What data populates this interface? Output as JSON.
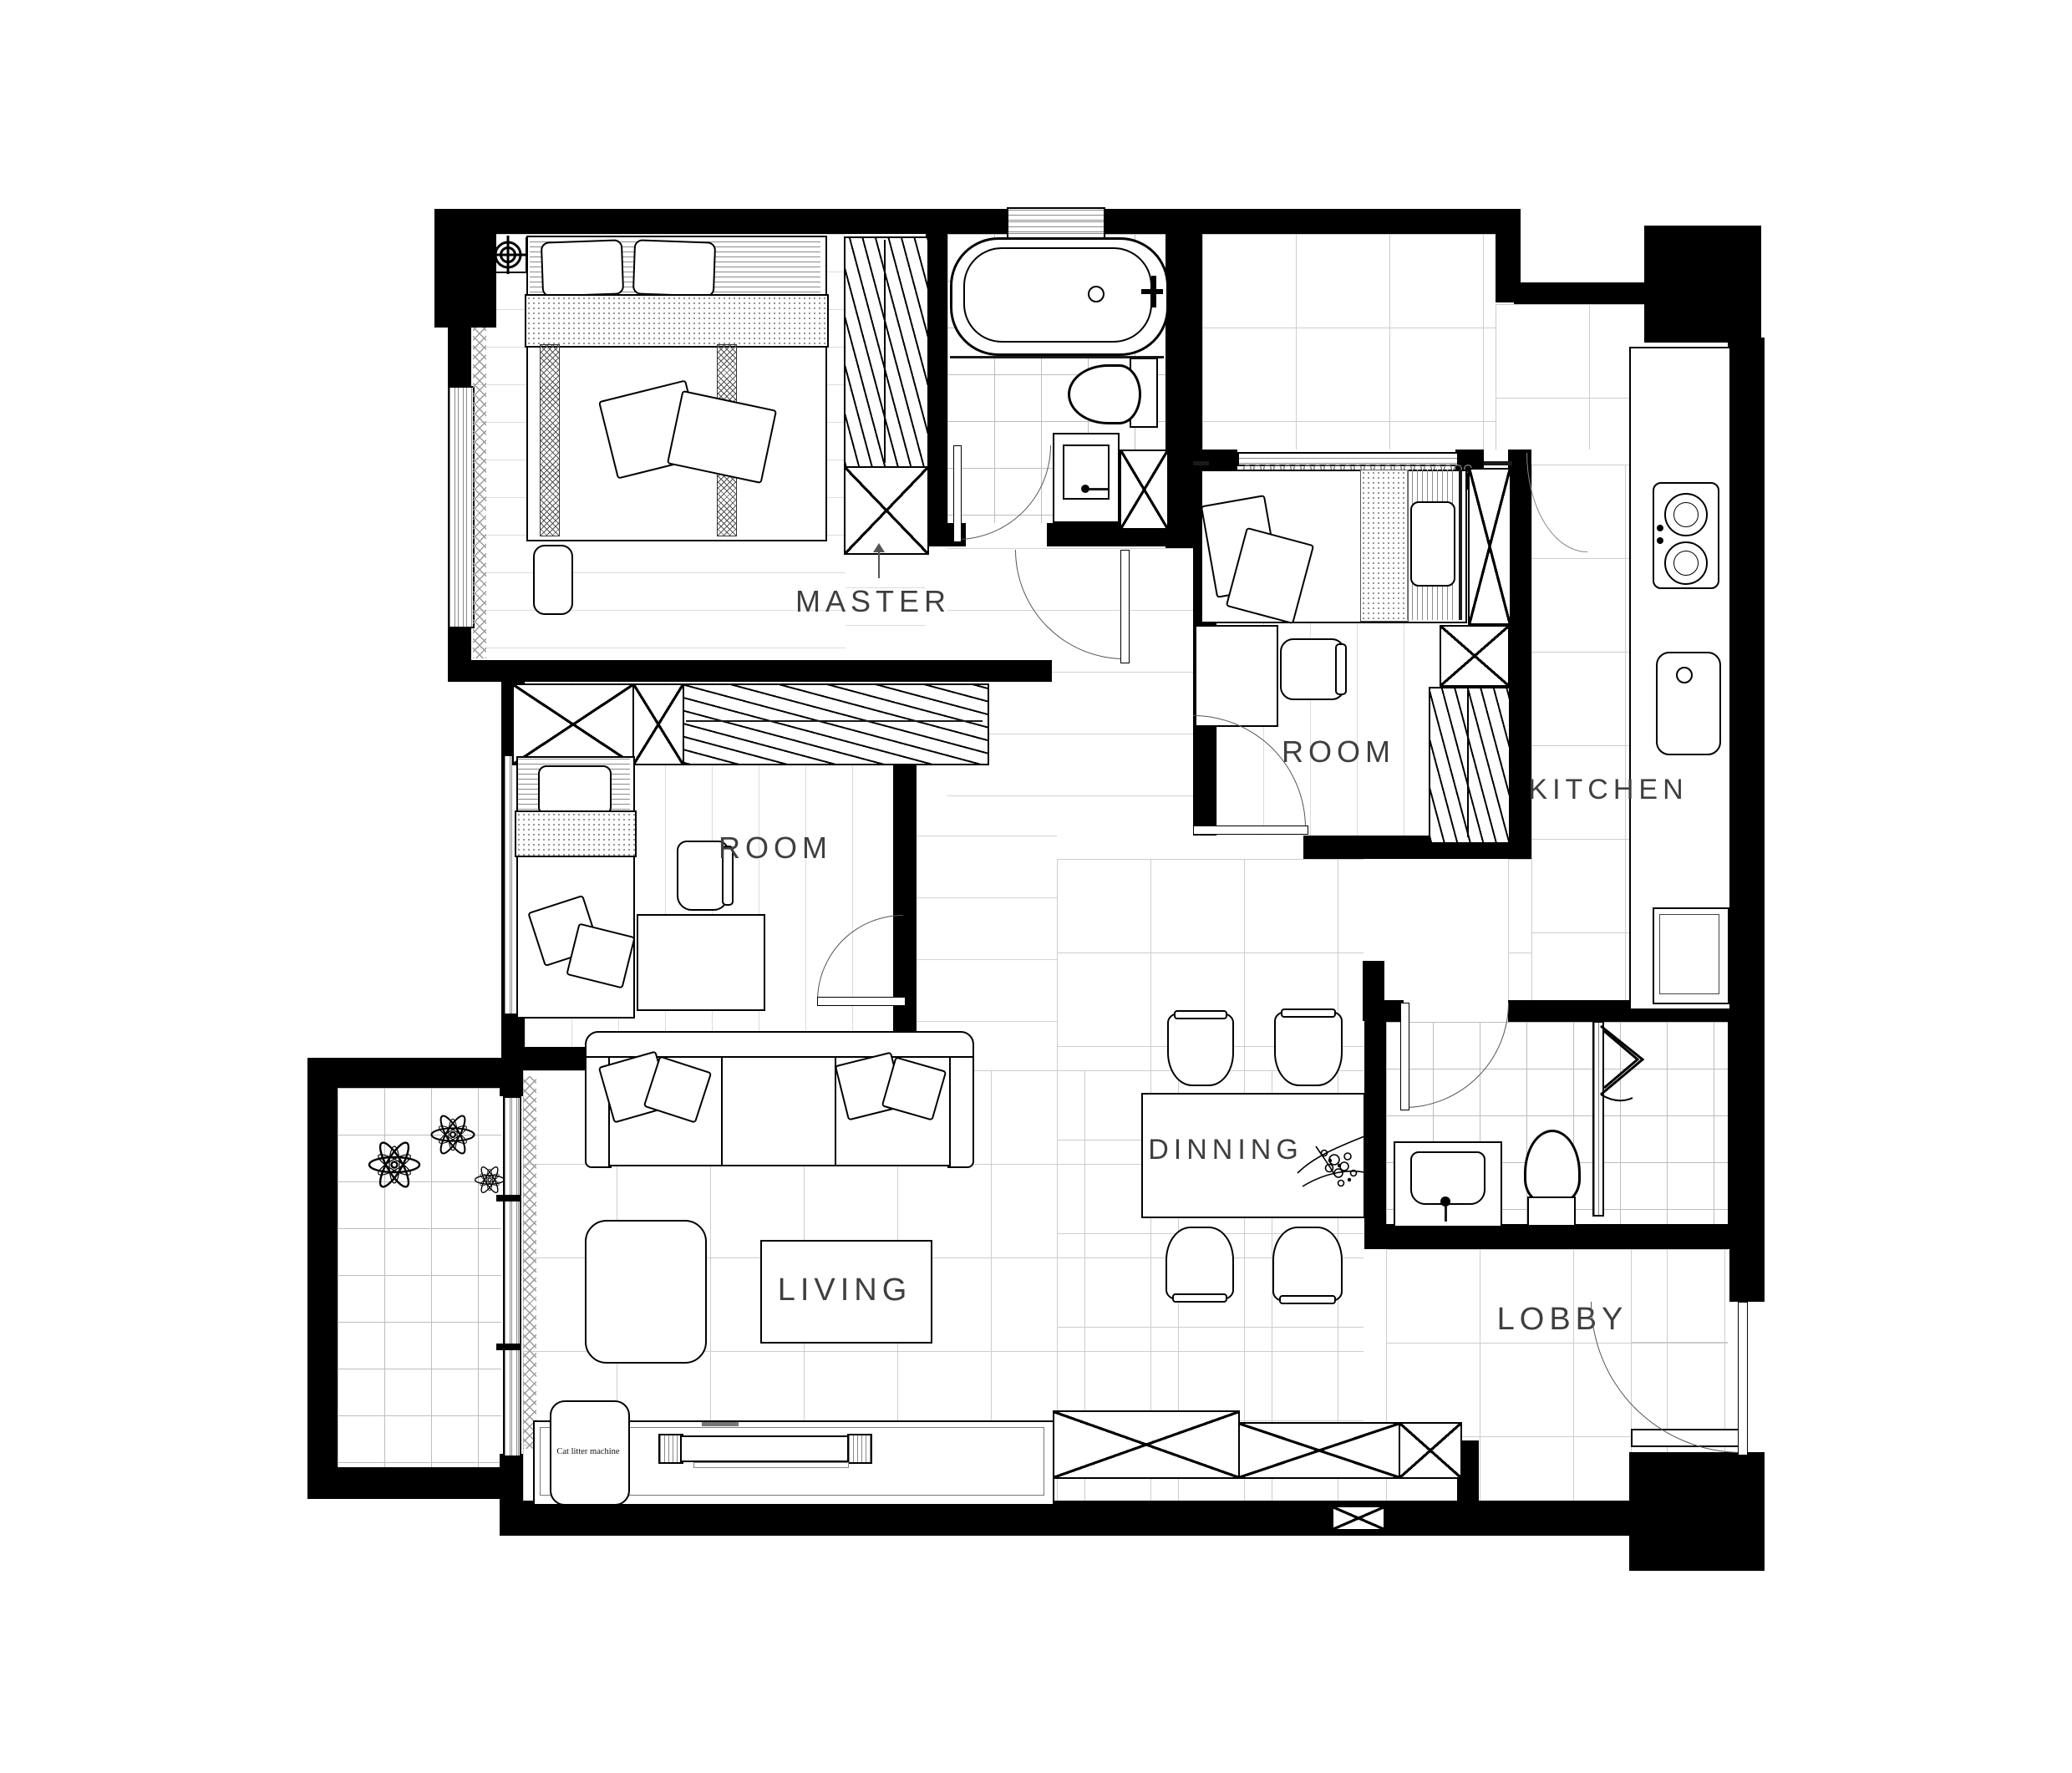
{
  "plan": {
    "title": "apartment-floor-plan",
    "rooms": {
      "master": {
        "label": "MASTER"
      },
      "room_left": {
        "label": "ROOM"
      },
      "room_right": {
        "label": "ROOM"
      },
      "kitchen": {
        "label": "KITCHEN"
      },
      "dining": {
        "label": "DINNING"
      },
      "living": {
        "label": "LIVING"
      },
      "lobby": {
        "label": "LOBBY"
      }
    },
    "annotations": {
      "cat_litter_machine": "Cat litter machine"
    },
    "colors": {
      "wall": "#000000",
      "tile_line": "#cdcdcd",
      "label_text": "#3f3f3f",
      "background": "#ffffff"
    }
  }
}
